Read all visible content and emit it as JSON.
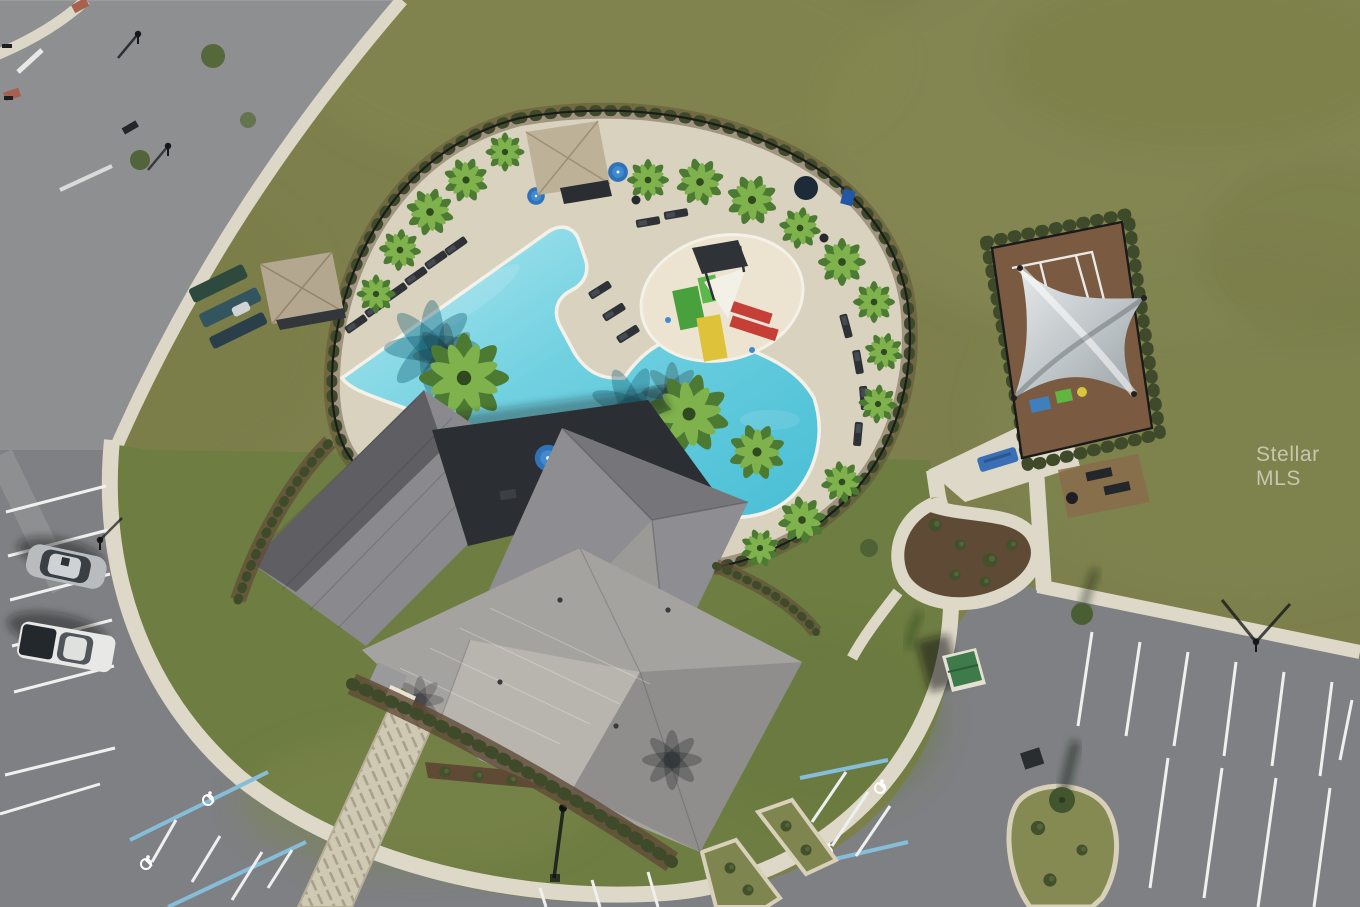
{
  "watermark": {
    "text": "Stellar MLS"
  },
  "photo": {
    "kind": "aerial-drone-photo",
    "subject": "community amenity center with resort pool, clubhouse, splash pad, shaded playground and parking",
    "objects": [
      "freeform-pool",
      "splash-pad-slides",
      "clubhouse-hip-roof",
      "pool-deck-pavers",
      "pool-fence",
      "palm-trees",
      "pool-cabana",
      "kayak-racks",
      "blue-umbrellas",
      "lounge-chairs",
      "playground-shade-sail",
      "playground-mulch",
      "picnic-benches",
      "green-utility-shed",
      "curved-sidewalk-ring",
      "entry-walkway",
      "street-top-left",
      "parking-lot",
      "accessible-parking-blue-hatch",
      "wheelchair-markings",
      "silver-sedan",
      "white-pickup-truck",
      "landscape-islands",
      "street-lights",
      "storm-drain"
    ],
    "vehicle_count": 2,
    "accessible_symbol_count": 4
  },
  "palette": {
    "grass": "#7d804c",
    "lawn": "#6e7d42",
    "asphalt": "#7e8083",
    "road": "#8d8f91",
    "concrete": "#ddd8c7",
    "paver_deck": "#d8d2bf",
    "mulch": "#6b4f3a",
    "hedge": "#3f4a2a",
    "water": "#52c5da",
    "water_light": "#ace6ee",
    "roof_light": "#a5a3a0",
    "roof_mid": "#8b8a8e",
    "roof_dark": "#5e5e63",
    "courtyard_shadow": "#2b2e33",
    "shade_sail": "#c9cdcf",
    "umbrella_blue": "#2f72b8",
    "handicap_blue": "#86bdd9",
    "slide_red": "#c53f36",
    "slide_yellow": "#dec23a",
    "slide_green": "#48a13c",
    "bench_blue": "#3a6fb5",
    "shed_green": "#3e7a4a",
    "stripe_white": "#f0f0ee"
  }
}
